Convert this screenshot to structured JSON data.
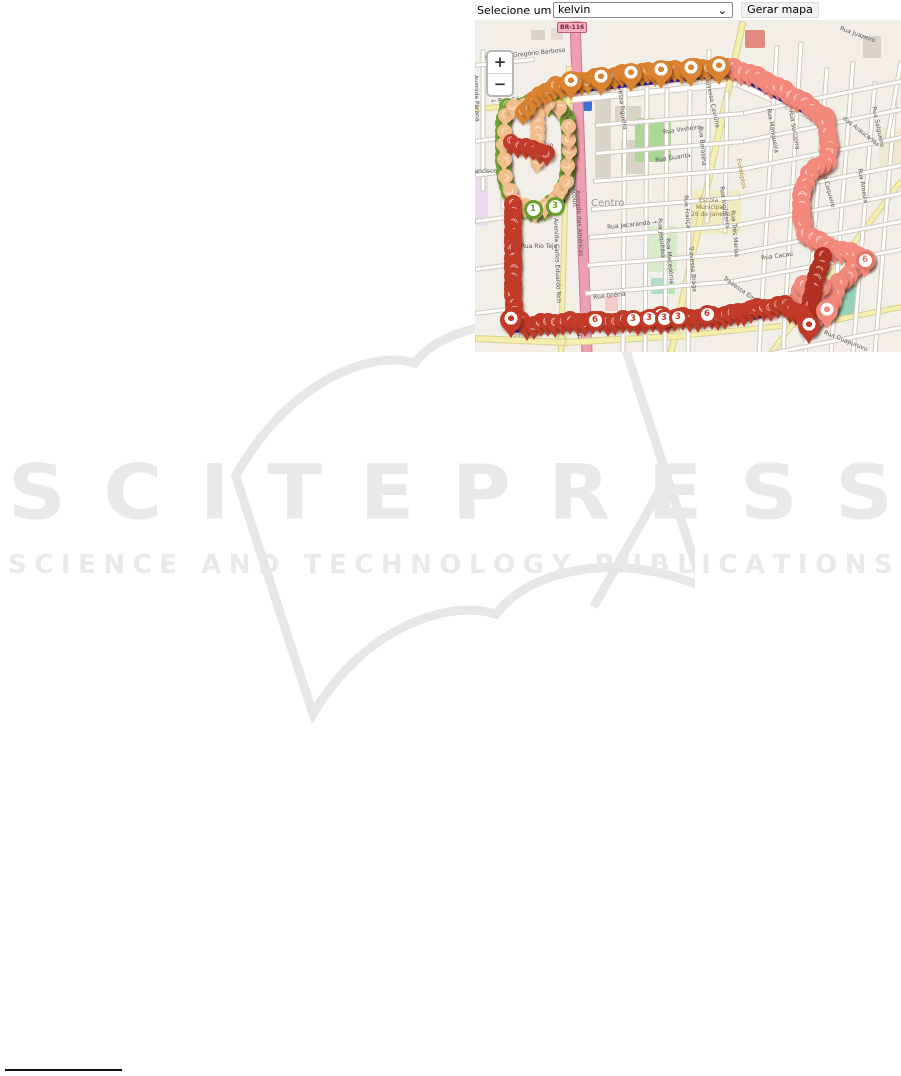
{
  "toolbar": {
    "label": "Selecione um usuário:",
    "selected_user": "kelvin",
    "chevron": "⌄",
    "generate_button": "Gerar mapa"
  },
  "watermark": {
    "title": "SCITEPRESS",
    "subtitle": "SCIENCE AND TECHNOLOGY PUBLICATIONS"
  },
  "map": {
    "zoom_in": "+",
    "zoom_out": "−",
    "shield": "BR-116",
    "glyph": "☾",
    "colors": {
      "background": "#f2efe9",
      "route_line": "#2525c4",
      "orange": "#d9822f",
      "salmon": "#f3897b",
      "red": "#c23a28",
      "dark_red": "#b23222",
      "green": "#6fa433",
      "peach": "#f2be8c"
    },
    "areas": [
      [
        120,
        70,
        16,
        88,
        "#dad3c8",
        1
      ],
      [
        140,
        86,
        26,
        20,
        "#dad3c8",
        1
      ],
      [
        146,
        120,
        26,
        34,
        "#dad3c8",
        1
      ],
      [
        56,
        10,
        14,
        10,
        "#dad3c8",
        1
      ],
      [
        76,
        8,
        12,
        12,
        "#e8dad6",
        1
      ],
      [
        388,
        16,
        18,
        22,
        "#dad3c8",
        1
      ],
      [
        270,
        10,
        20,
        18,
        "#e28a80",
        2
      ],
      [
        0,
        156,
        13,
        50,
        "#eadcee",
        1
      ],
      [
        130,
        276,
        13,
        15,
        "#f6caca",
        1
      ],
      [
        214,
        170,
        52,
        44,
        "#f2ecc3",
        2
      ],
      [
        160,
        98,
        36,
        44,
        "#abd695",
        2
      ],
      [
        172,
        206,
        30,
        46,
        "#d8eccb",
        2
      ],
      [
        352,
        260,
        32,
        36,
        "#96d2b9",
        2
      ],
      [
        176,
        258,
        12,
        16,
        "#aee0c8",
        1
      ],
      [
        190,
        262,
        10,
        12,
        "#b9e6b1",
        1
      ],
      [
        404,
        108,
        22,
        40,
        "#efe9d2",
        1
      ],
      [
        80,
        314,
        13,
        13,
        "#c7e3a4",
        50
      ],
      [
        108,
        80,
        9,
        11,
        "#3b6fd4",
        2
      ]
    ],
    "roads": [
      [
        100,
        0,
        112,
        332,
        9,
        "p"
      ],
      [
        58,
        82,
        262,
        62,
        5,
        "w"
      ],
      [
        262,
        62,
        356,
        104,
        5,
        "w"
      ],
      [
        0,
        88,
        96,
        80,
        4,
        "y"
      ],
      [
        94,
        45,
        86,
        332,
        4,
        "y"
      ],
      [
        268,
        0,
        196,
        332,
        5,
        "y"
      ],
      [
        0,
        317,
        90,
        321,
        5,
        "y"
      ],
      [
        90,
        321,
        214,
        314,
        5,
        "y"
      ],
      [
        214,
        314,
        356,
        300,
        4,
        "y"
      ],
      [
        356,
        300,
        426,
        286,
        4,
        "y"
      ],
      [
        426,
        160,
        296,
        332,
        4,
        "y"
      ],
      [
        8,
        28,
        8,
        168,
        3,
        "w"
      ],
      [
        30,
        92,
        28,
        186,
        3,
        "w"
      ],
      [
        62,
        86,
        62,
        150,
        3,
        "w"
      ],
      [
        150,
        62,
        148,
        332,
        3,
        "w"
      ],
      [
        172,
        64,
        170,
        332,
        3,
        "w"
      ],
      [
        192,
        66,
        190,
        332,
        3,
        "w"
      ],
      [
        215,
        68,
        213,
        332,
        3,
        "w"
      ],
      [
        234,
        28,
        232,
        200,
        3,
        "w"
      ],
      [
        252,
        70,
        250,
        210,
        3,
        "w"
      ],
      [
        302,
        24,
        284,
        332,
        3,
        "w"
      ],
      [
        326,
        20,
        308,
        332,
        3,
        "w"
      ],
      [
        352,
        46,
        330,
        332,
        3,
        "w"
      ],
      [
        378,
        40,
        356,
        332,
        3,
        "w"
      ],
      [
        400,
        60,
        378,
        332,
        3,
        "w"
      ],
      [
        420,
        80,
        400,
        332,
        3,
        "w"
      ],
      [
        426,
        40,
        412,
        120,
        3,
        "w"
      ],
      [
        0,
        44,
        58,
        38,
        3,
        "w"
      ],
      [
        120,
        104,
        268,
        92,
        3,
        "w"
      ],
      [
        268,
        92,
        426,
        60,
        3,
        "w"
      ],
      [
        120,
        132,
        268,
        120,
        3,
        "w"
      ],
      [
        268,
        120,
        426,
        88,
        3,
        "w"
      ],
      [
        118,
        160,
        266,
        148,
        3,
        "w"
      ],
      [
        266,
        148,
        426,
        116,
        3,
        "w"
      ],
      [
        116,
        188,
        264,
        176,
        3,
        "w"
      ],
      [
        264,
        176,
        426,
        144,
        3,
        "w"
      ],
      [
        114,
        216,
        262,
        204,
        3,
        "w"
      ],
      [
        262,
        204,
        426,
        172,
        3,
        "w"
      ],
      [
        112,
        244,
        260,
        232,
        3,
        "w"
      ],
      [
        260,
        232,
        426,
        200,
        3,
        "w"
      ],
      [
        110,
        272,
        258,
        260,
        3,
        "w"
      ],
      [
        258,
        260,
        426,
        228,
        3,
        "w"
      ],
      [
        256,
        288,
        380,
        262,
        3,
        "w"
      ],
      [
        296,
        332,
        426,
        306,
        3,
        "w"
      ],
      [
        0,
        120,
        30,
        116,
        3,
        "w"
      ],
      [
        0,
        154,
        30,
        150,
        3,
        "w"
      ],
      [
        0,
        200,
        30,
        196,
        3,
        "w"
      ],
      [
        0,
        248,
        30,
        244,
        3,
        "w"
      ],
      [
        0,
        292,
        32,
        288,
        3,
        "w"
      ]
    ],
    "labels": [
      [
        "Rua João Gregório Barbosa",
        10,
        36,
        -6,
        6,
        "#555"
      ],
      [
        "Avenida Paraná",
        3,
        55,
        88,
        6,
        "#555"
      ],
      [
        "← Rua César Carelli",
        16,
        79,
        -4,
        6,
        "#555"
      ],
      [
        "Francisco C",
        -6,
        149,
        0,
        6,
        "#555"
      ],
      [
        "Rua Rio Tejo",
        42,
        123,
        0,
        6,
        "#555"
      ],
      [
        "Rua Rio Tejo",
        46,
        224,
        0,
        6,
        "#555"
      ],
      [
        "Travessa Figueira",
        146,
        58,
        83,
        6,
        "#555"
      ],
      [
        "Travessa Caviúna",
        234,
        56,
        78,
        6,
        "#555"
      ],
      [
        "Rua Barasina",
        228,
        106,
        85,
        6,
        "#555"
      ],
      [
        "Rua Vinheiro",
        188,
        110,
        -8,
        6,
        "#555"
      ],
      [
        "Rua Guarita",
        180,
        138,
        -8,
        6,
        "#555"
      ],
      [
        "Centro",
        116,
        179,
        0,
        10,
        "#999"
      ],
      [
        "Rua Jacarandá →",
        132,
        205,
        -6,
        6,
        "#555"
      ],
      [
        "Rua Inglaterra",
        249,
        166,
        82,
        6,
        "#555"
      ],
      [
        "Rua França",
        213,
        175,
        85,
        6,
        "#555"
      ],
      [
        "Rua Jequitibá",
        187,
        198,
        85,
        6,
        "#555"
      ],
      [
        "Rua Grécia",
        118,
        275,
        -6,
        6,
        "#555"
      ],
      [
        "Rua Macedônia",
        195,
        218,
        85,
        6,
        "#555"
      ],
      [
        "Travessa Braga",
        218,
        226,
        85,
        6,
        "#555"
      ],
      [
        "Bitencourt",
        100,
        156,
        86,
        6,
        "#555"
      ],
      [
        "Avenida das Américas",
        105,
        170,
        87,
        6,
        "#555"
      ],
      [
        "Avenida Carlos Eduardo Nch",
        83,
        198,
        88,
        6,
        "#555"
      ],
      [
        "Santa Terezinha",
        38,
        313,
        -4,
        6,
        "#8a8a6a"
      ],
      [
        "✝",
        101,
        314,
        0,
        7,
        "#555"
      ],
      [
        "Rua Guapuruvu",
        350,
        310,
        22,
        6,
        "#555"
      ],
      [
        "Rua Juazeiro",
        366,
        6,
        20,
        6,
        "#555"
      ],
      [
        "Rua Mangueira",
        296,
        88,
        80,
        6,
        "#555"
      ],
      [
        "Rua Sucupira",
        318,
        90,
        80,
        6,
        "#555"
      ],
      [
        "das Araucárias",
        370,
        96,
        38,
        6,
        "#555"
      ],
      [
        "Rua Salgueiro",
        401,
        86,
        78,
        6,
        "#555"
      ],
      [
        "Rua Coqueiro",
        350,
        148,
        75,
        6,
        "#555"
      ],
      [
        "Rua Aroeira",
        387,
        148,
        80,
        6,
        "#555"
      ],
      [
        "Rua Três Marias",
        260,
        190,
        85,
        6,
        "#555"
      ],
      [
        "Rua Cacau",
        286,
        236,
        -8,
        6,
        "#555"
      ],
      [
        "Travessa Embaúba",
        250,
        256,
        35,
        6,
        "#555"
      ],
      [
        "Eucaliptos",
        266,
        138,
        80,
        6,
        "#b08830"
      ],
      [
        "Escola",
        224,
        178,
        0,
        6,
        "#8a7a45"
      ],
      [
        "Municipal",
        221,
        185,
        0,
        6,
        "#8a7a45"
      ],
      [
        "26 de Janeiro",
        216,
        192,
        0,
        6,
        "#8a7a45"
      ]
    ],
    "bluelines": [
      [
        80,
        73,
        258,
        54
      ],
      [
        258,
        54,
        352,
        104
      ],
      [
        352,
        104,
        355,
        138
      ],
      [
        330,
        222,
        392,
        244
      ],
      [
        32,
        186,
        32,
        300
      ],
      [
        36,
        311,
        274,
        299
      ],
      [
        274,
        299,
        318,
        289
      ],
      [
        334,
        305,
        349,
        248
      ],
      [
        36,
        191,
        90,
        181
      ]
    ],
    "paths": [
      {
        "c": "#6fa433",
        "r": 8,
        "step": 7,
        "pts": [
          [
            32,
            86
          ],
          [
            28,
            104
          ],
          [
            28,
            122
          ],
          [
            28,
            140
          ],
          [
            30,
            158
          ],
          [
            34,
            174
          ],
          [
            42,
            186
          ],
          [
            56,
            191
          ],
          [
            70,
            188
          ],
          [
            82,
            178
          ],
          [
            90,
            164
          ],
          [
            93,
            148
          ],
          [
            94,
            130
          ],
          [
            94,
            112
          ],
          [
            92,
            96
          ],
          [
            82,
            86
          ],
          [
            66,
            82
          ],
          [
            48,
            84
          ]
        ]
      },
      {
        "c": "#f2be8c",
        "r": 7.5,
        "step": 13,
        "pts": [
          [
            30,
            95
          ],
          [
            28,
            125
          ],
          [
            30,
            156
          ],
          [
            40,
            183
          ],
          [
            60,
            190
          ],
          [
            80,
            180
          ],
          [
            91,
            160
          ],
          [
            94,
            132
          ],
          [
            93,
            105
          ],
          [
            84,
            88
          ],
          [
            60,
            82
          ],
          [
            38,
            88
          ]
        ]
      },
      {
        "c": "#f2be8c",
        "r": 7.5,
        "step": 8,
        "pts": [
          [
            62,
            94
          ],
          [
            62,
            142
          ]
        ]
      },
      {
        "c": "#d9822f",
        "r": 8.5,
        "step": 7,
        "pts": [
          [
            48,
            92
          ],
          [
            58,
            80
          ],
          [
            70,
            71
          ],
          [
            80,
            66
          ]
        ]
      },
      {
        "c": "#c23a28",
        "r": 8,
        "step": 7,
        "pts": [
          [
            36,
            122
          ],
          [
            58,
            129
          ],
          [
            72,
            132
          ]
        ]
      },
      {
        "c": "#d9822f",
        "r": 9,
        "step": 7,
        "pts": [
          [
            80,
            66
          ],
          [
            120,
            58
          ],
          [
            160,
            53
          ],
          [
            200,
            50
          ],
          [
            240,
            47
          ],
          [
            258,
            47
          ]
        ]
      },
      {
        "c": "#f3897b",
        "r": 9.5,
        "step": 8,
        "pts": [
          [
            258,
            47
          ],
          [
            290,
            60
          ],
          [
            322,
            78
          ],
          [
            350,
            97
          ],
          [
            354,
            126
          ],
          [
            352,
            140
          ],
          [
            334,
            154
          ],
          [
            327,
            170
          ],
          [
            326,
            198
          ],
          [
            330,
            212
          ],
          [
            352,
            226
          ],
          [
            375,
            233
          ],
          [
            390,
            238
          ],
          [
            378,
            250
          ],
          [
            363,
            264
          ],
          [
            357,
            280
          ],
          [
            351,
            292
          ],
          [
            339,
            298
          ],
          [
            328,
            289
          ],
          [
            323,
            277
          ],
          [
            328,
            266
          ],
          [
            338,
            261
          ],
          [
            346,
            266
          ]
        ]
      },
      {
        "c": "#b23222",
        "r": 9,
        "step": 7,
        "pts": [
          [
            348,
            236
          ],
          [
            341,
            258
          ],
          [
            336,
            280
          ],
          [
            332,
            300
          ]
        ]
      },
      {
        "c": "#c23a28",
        "r": 9,
        "step": 7,
        "pts": [
          [
            38,
            184
          ],
          [
            38,
            230
          ],
          [
            38,
            276
          ],
          [
            40,
            297
          ],
          [
            52,
            305
          ],
          [
            80,
            302
          ],
          [
            110,
            301
          ],
          [
            140,
            301
          ],
          [
            170,
            300
          ],
          [
            200,
            298
          ],
          [
            230,
            297
          ],
          [
            256,
            294
          ],
          [
            282,
            288
          ],
          [
            310,
            285
          ],
          [
            326,
            294
          ],
          [
            334,
            305
          ]
        ]
      }
    ],
    "pins": [
      [
        36,
        300,
        "#c23a28"
      ],
      [
        186,
        297,
        "#c23a28"
      ],
      [
        334,
        306,
        "#c23a28"
      ],
      [
        96,
        62,
        "#d9822f"
      ],
      [
        126,
        58,
        "#d9822f"
      ],
      [
        156,
        54,
        "#d9822f"
      ],
      [
        186,
        51,
        "#d9822f"
      ],
      [
        216,
        49,
        "#d9822f"
      ],
      [
        244,
        47,
        "#d9822f"
      ],
      [
        352,
        291,
        "#f3897b"
      ],
      [
        390,
        240,
        "#f3897b"
      ]
    ],
    "badges": [
      [
        120,
        300,
        "6",
        "#c23a28"
      ],
      [
        158,
        299,
        "3",
        "#c23a28"
      ],
      [
        174,
        298,
        "3",
        "#c23a28"
      ],
      [
        189,
        298,
        "3",
        "#c23a28"
      ],
      [
        203,
        297,
        "3",
        "#c23a28"
      ],
      [
        232,
        294,
        "6",
        "#c23a28"
      ],
      [
        58,
        189,
        "1",
        "#6a9e2f"
      ],
      [
        80,
        186,
        "3",
        "#6a9e2f"
      ],
      [
        390,
        240,
        "6",
        "#e0756b"
      ]
    ]
  }
}
